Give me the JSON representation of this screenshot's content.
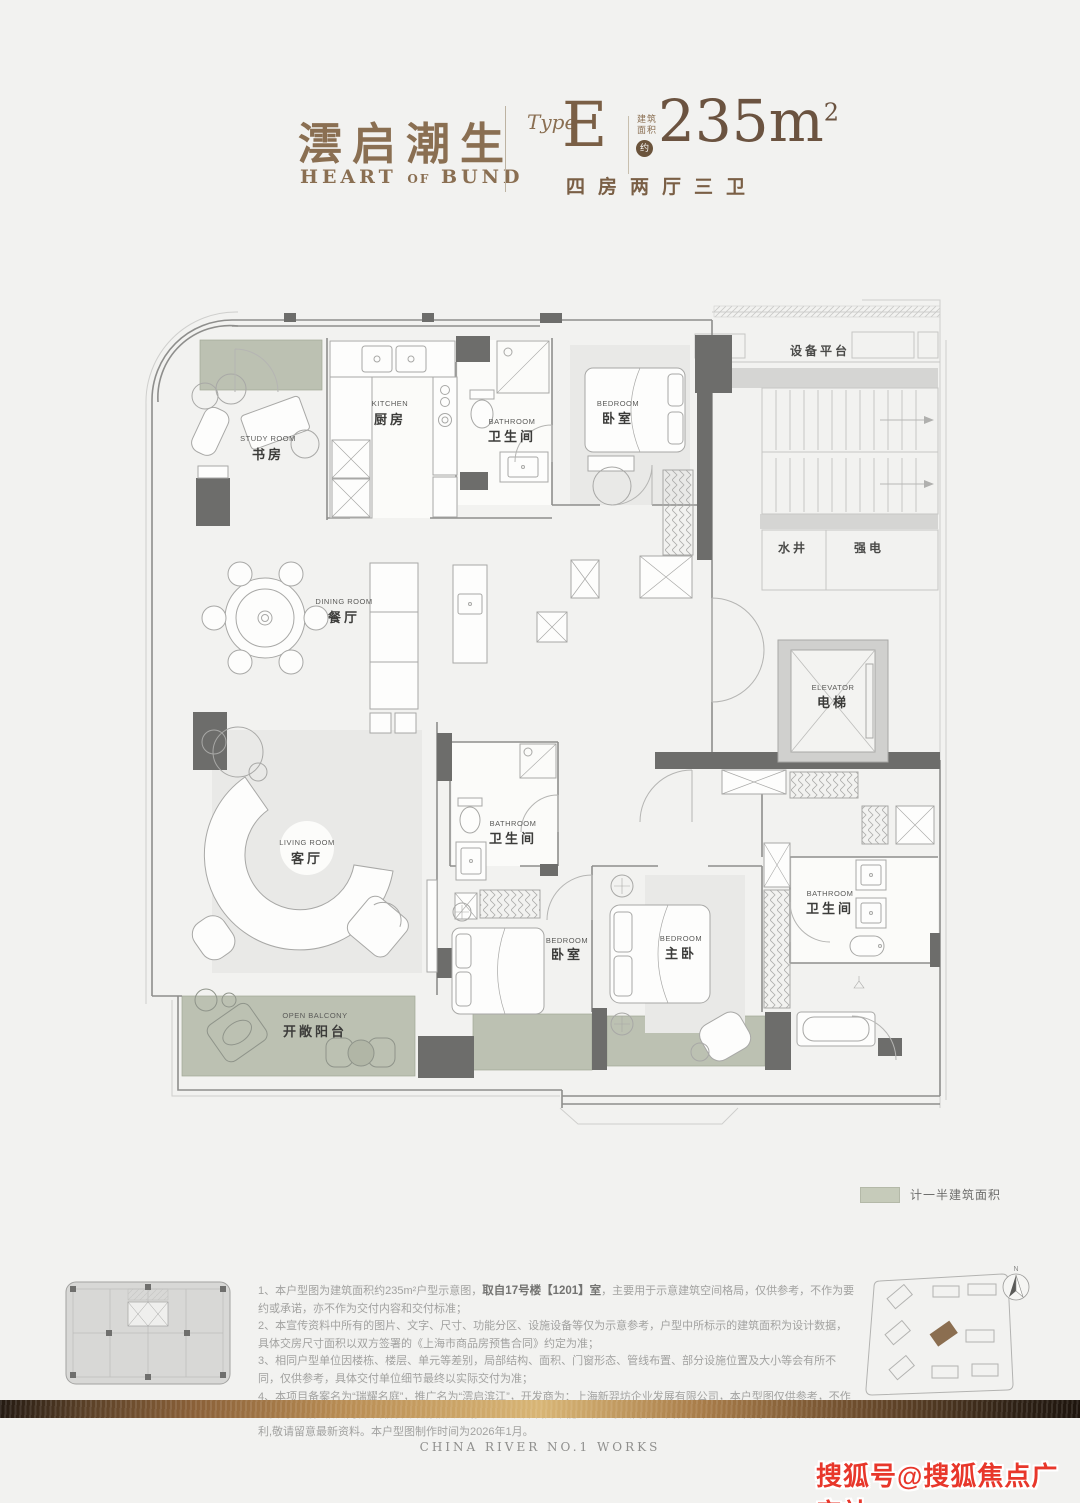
{
  "header": {
    "title_cn": "澐启潮生",
    "title_en_1": "HEART",
    "title_en_2": "OF",
    "title_en_3": "BUND",
    "type_label": "Type",
    "type_value": "E",
    "area_label_line1": "建筑",
    "area_label_line2": "面积",
    "area_approx": "约",
    "area_value": "235m",
    "area_sup": "2",
    "layout_summary": "四房两厅三卫"
  },
  "floorplan": {
    "rooms": [
      {
        "en": "STUDY ROOM",
        "cn": "书房"
      },
      {
        "en": "KITCHEN",
        "cn": "厨房"
      },
      {
        "en": "BATHROOM",
        "cn": "卫生间"
      },
      {
        "en": "BEDROOM",
        "cn": "卧室"
      },
      {
        "cn": "设备平台"
      },
      {
        "cn": "水井"
      },
      {
        "cn": "强电"
      },
      {
        "en": "DINING ROOM",
        "cn": "餐厅"
      },
      {
        "en": "ELEVATOR",
        "cn": "电梯"
      },
      {
        "en": "LIVING ROOM",
        "cn": "客厅"
      },
      {
        "en": "BATHROOM",
        "cn": "卫生间"
      },
      {
        "en": "BEDROOM",
        "cn": "卧室"
      },
      {
        "en": "BEDROOM",
        "cn": "主卧"
      },
      {
        "en": "BATHROOM",
        "cn": "卫生间"
      },
      {
        "en": "OPEN BALCONY",
        "cn": "开敞阳台"
      }
    ]
  },
  "legend": {
    "label": "计一半建筑面积",
    "swatch_color": "#c6cbba"
  },
  "notes": {
    "n1a": "1、本户型图为建筑面积约235m²户型示意图，",
    "n1b": "取自17号楼【1201】室",
    "n1c": "，主要用于示意建筑空间格局，仅供参考，不作为要约或承诺，亦不作为交付内容和交付标准；",
    "n2": "2、本宣传资料中所有的图片、文字、尺寸、功能分区、设施设备等仅为示意参考，户型中所标示的建筑面积为设计数据，具体交房尺寸面积以双方签署的《上海市商品房预售合同》约定为准；",
    "n3": "3、相同户型单位因楼栋、楼层、单元等差别，局部结构、面积、门窗形态、管线布置、部分设施位置及大小等会有所不同，仅供参考，具体交付单位细节最终以实际交付为准；",
    "n4": "4、本项目备案名为“瑞耀名庭”，推广名为“澐启滨江”，开发商为：上海新羿坊企业发展有限公司，本户型图仅供参考，不作为要约邀请，相关内容不排除因政府相关规划、规定及开发商未能知晓的原因而发生变化，本公司保留对宣传资料修改的权利,敬请留意最新资料。本户型图制作时间为2026年1月。"
  },
  "siteplan": {
    "compass_label": "N"
  },
  "footer": {
    "slogan": "CHINA RIVER NO.1 WORKS"
  },
  "watermark": {
    "text": "搜狐号@搜狐焦点广安站"
  },
  "colors": {
    "accent_brown": "#8a6f52",
    "sage_half_area": "#bcc1b2",
    "wall_dark": "#6d6d6b",
    "watermark_red": "#e8372b"
  }
}
